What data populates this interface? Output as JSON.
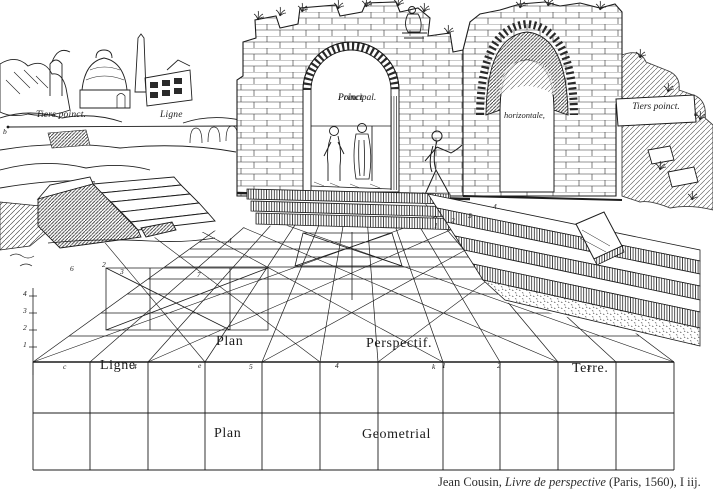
{
  "figure": {
    "labels": {
      "tiers_poinct_left": "Tiers poinct.",
      "ligne_horizontale_left": "Ligne",
      "poinct_principal_line1": "Poinct",
      "poinct_principal_line2": "Principal.",
      "horizontale": "horizontale,",
      "tiers_poinct_right": "Tiers poinct.",
      "plan_perspectif_word1": "Plan",
      "plan_perspectif_word2": "Perspectif.",
      "ligne_terre_word1": "Ligne",
      "ligne_terre_word2": "Terre.",
      "plan_geometrial_word1": "Plan",
      "plan_geometrial_word2": "Geometrial"
    },
    "annotations": [
      {
        "text": "b",
        "x": 3,
        "y": 128
      },
      {
        "text": "4",
        "x": 23,
        "y": 290
      },
      {
        "text": "3",
        "x": 23,
        "y": 307
      },
      {
        "text": "2",
        "x": 23,
        "y": 324
      },
      {
        "text": "1",
        "x": 23,
        "y": 341
      },
      {
        "text": "6",
        "x": 70,
        "y": 265
      },
      {
        "text": "2",
        "x": 102,
        "y": 261
      },
      {
        "text": "3",
        "x": 120,
        "y": 268
      },
      {
        "text": "7",
        "x": 197,
        "y": 271
      },
      {
        "text": "4",
        "x": 228,
        "y": 237
      },
      {
        "text": "1",
        "x": 434,
        "y": 222
      },
      {
        "text": "2",
        "x": 451,
        "y": 217
      },
      {
        "text": "3",
        "x": 468,
        "y": 212
      },
      {
        "text": "4",
        "x": 493,
        "y": 203
      },
      {
        "text": "c",
        "x": 63,
        "y": 363
      },
      {
        "text": "4",
        "x": 133,
        "y": 363
      },
      {
        "text": "e",
        "x": 198,
        "y": 362
      },
      {
        "text": "5",
        "x": 249,
        "y": 363
      },
      {
        "text": "4",
        "x": 335,
        "y": 362
      },
      {
        "text": "k",
        "x": 432,
        "y": 363
      },
      {
        "text": "1",
        "x": 442,
        "y": 362
      },
      {
        "text": "2",
        "x": 497,
        "y": 362
      },
      {
        "text": "3",
        "x": 587,
        "y": 364
      },
      {
        "text": "a",
        "x": 694,
        "y": 110
      }
    ],
    "caption": {
      "pre": "Jean Cousin, ",
      "title": "Livre de perspective",
      "post": " (Paris, 1560), I iij."
    },
    "colors": {
      "ink": "#1c1c1c",
      "paper": "#ffffff"
    }
  }
}
